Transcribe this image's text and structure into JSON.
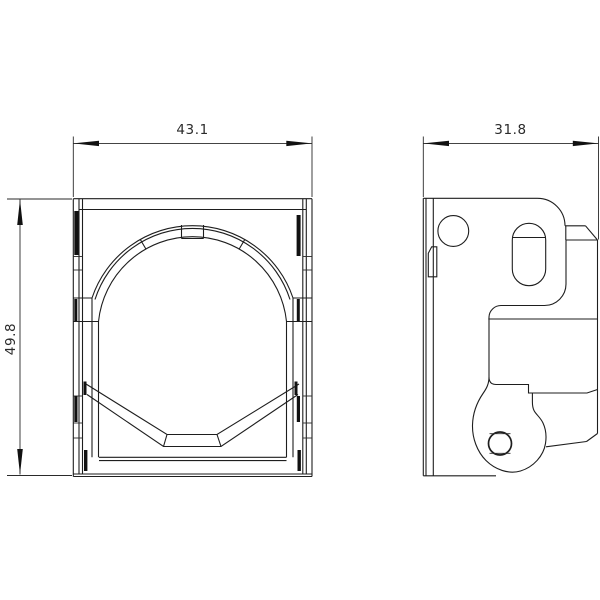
{
  "drawing": {
    "type": "technical-dimension-drawing",
    "dimensions": {
      "front_width": "43.1",
      "front_height": "49.8",
      "side_depth": "31.8"
    },
    "colors": {
      "line": "#1e1e1e",
      "background": "#ffffff",
      "text": "#2b2b2b"
    }
  }
}
